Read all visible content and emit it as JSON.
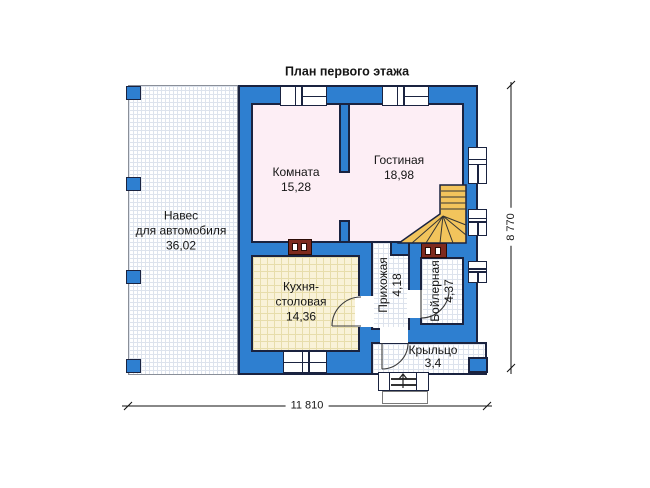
{
  "title": "План первого этажа",
  "colors": {
    "wall_blue": "#2e7fd0",
    "outline": "#1a2340",
    "room_pink": "#fdeef5",
    "kitchen_cream": "#f9f2d8",
    "stair_amber": "#f2c45c",
    "chimney_red": "#7e2a1e",
    "grid_line": "#dde3ed"
  },
  "rooms": {
    "carport": {
      "line1": "Навес",
      "line2": "для автомобиля",
      "area": "36,02"
    },
    "komnata": {
      "name": "Комната",
      "area": "15,28"
    },
    "gostinaya": {
      "name": "Гостиная",
      "area": "18,98"
    },
    "kitchen": {
      "line1": "Кухня-",
      "line2": "столовая",
      "area": "14,36"
    },
    "hallway": {
      "name": "Прихожая",
      "area": "4,18"
    },
    "boiler": {
      "name": "Бойлерная",
      "area": "4,37"
    },
    "porch": {
      "name": "Крыльцо",
      "area": "3,4"
    }
  },
  "dimensions": {
    "bottom": "11 810",
    "right": "8 770"
  }
}
